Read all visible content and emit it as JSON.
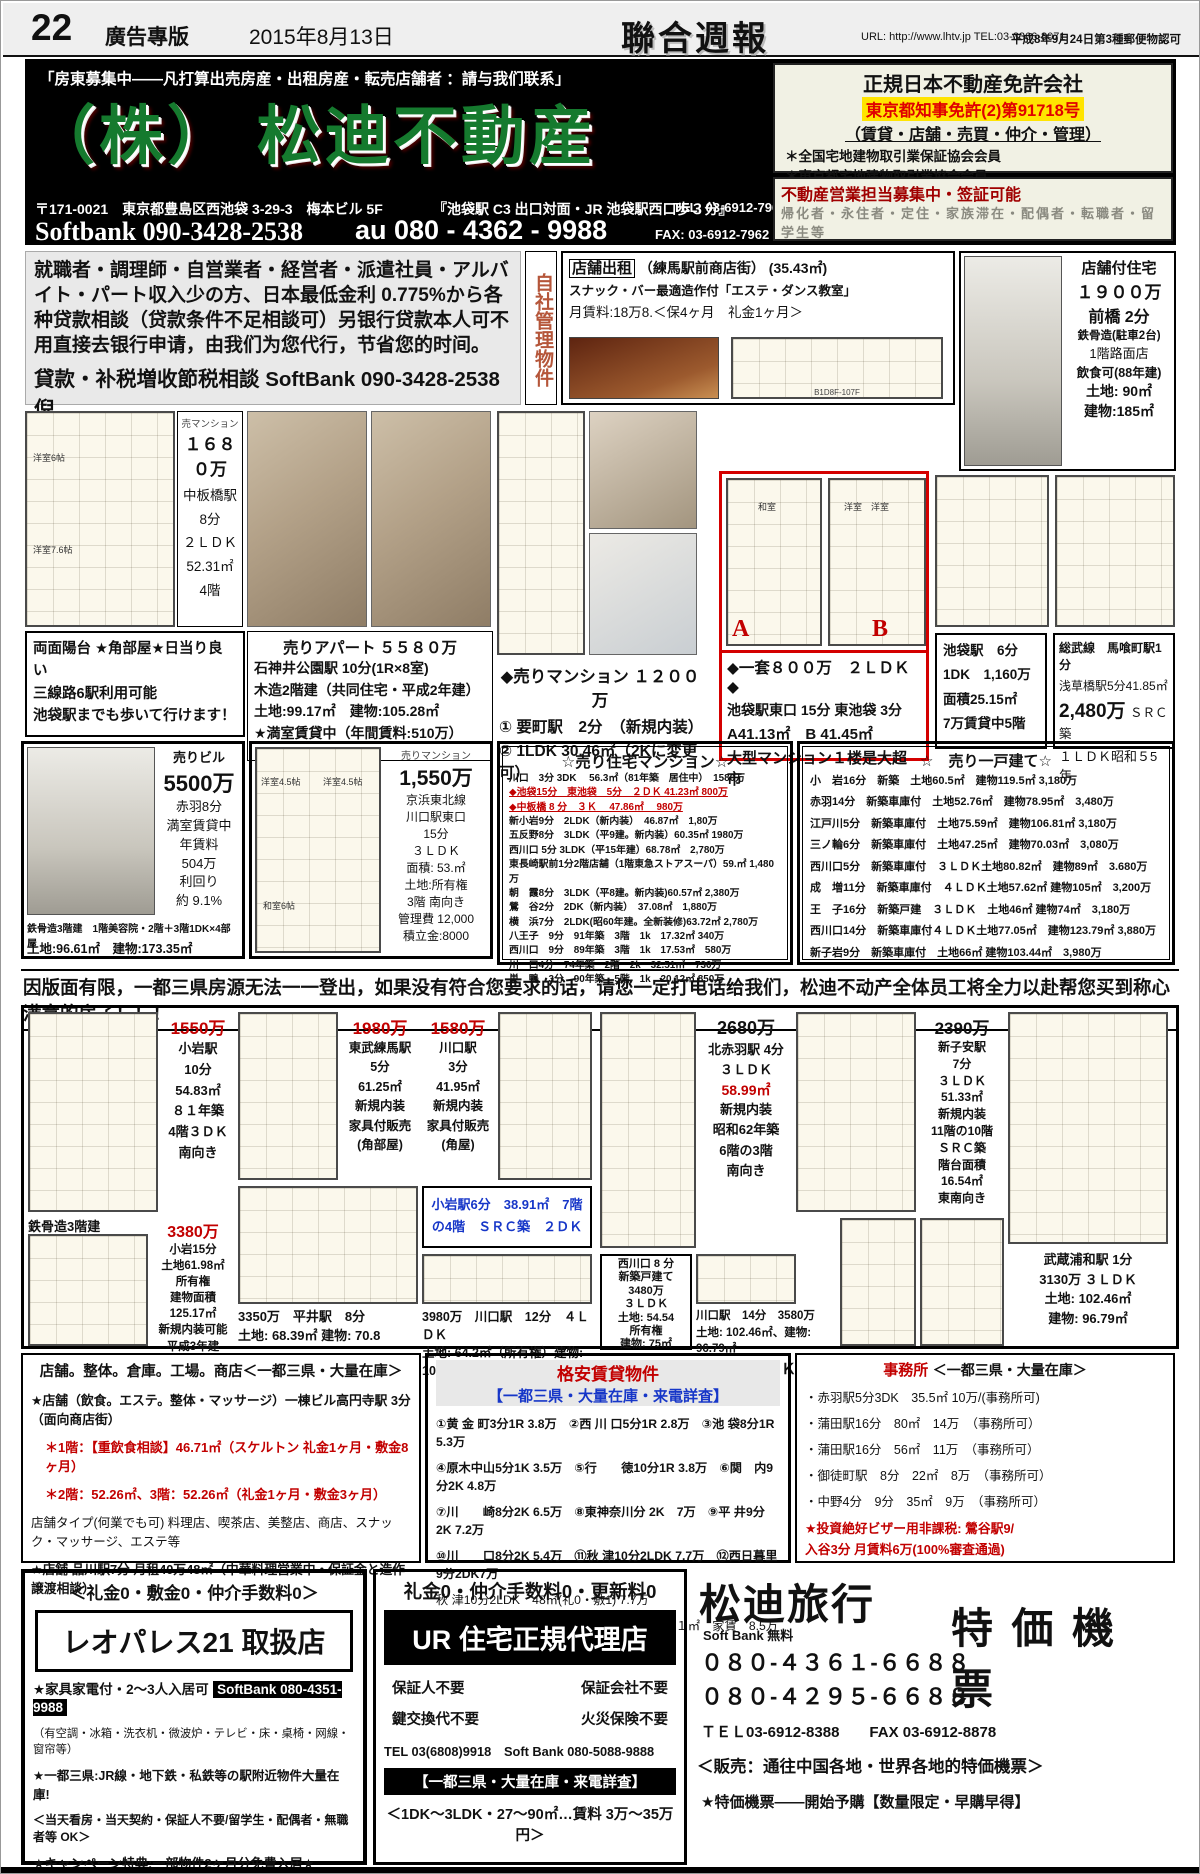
{
  "header": {
    "page_number": "22",
    "section": "廣告專版",
    "date": "2015年8月13日",
    "logo": "聯合週報",
    "contact": "URL: http://www.lhtv.jp  TEL:03-3366-8071",
    "approval": "平成8年9月24日第3種郵便物認可"
  },
  "main_ad": {
    "slogan": "「房東募集中——凡打算出売房産・出租房産・転売店舗者 ：請与我们联系」",
    "company": "（株） 松迪不動産",
    "address": "〒171-0021　東京都豊島区西池袋 3-29-3　梅本ビル 5F",
    "access": "『池袋駅 C3 出口対面・JR 池袋駅西口歩３分』",
    "tel": "TEL:  03-6912-7961",
    "softbank": "Softbank 090-3428-2538",
    "au": "au 080 - 4362 - 9988",
    "fax": "FAX:  03-6912-7962"
  },
  "license_box": {
    "title": "正規日本不動産免許会社",
    "license": "東京都知事免許(2)第91718号",
    "services": "（賃貸・店舗・売買・仲介・管理）",
    "member1": "＊全国宅地建物取引業保証協会会員",
    "member2": "＊東京都宅地建物取引業協会会員"
  },
  "recruit_box": {
    "title": "不動産営業担当募集中・签証可能",
    "body": "帰化者・永住者・定住・家族滞在・配偶者・転職者・留学生等"
  },
  "loan_ad": {
    "body": "就職者・調理師・自営業者・経営者・派遣社員・アルバイト・パート収入少の方、日本最低金利 0.775%から各种贷款相談（贷款条件不足相談可）另银行贷款本人可不用直接去银行申请，由我们为您代行，节省您的时间。",
    "contact": "貸款・补税増收節税相談 SoftBank 090-3428-2538 倪"
  },
  "self_managed": "自社管理物件",
  "shop_rent": {
    "tag": "店舗出租",
    "location": "（練馬駅前商店街）  (35.43㎡)",
    "desc": "スナック・バー最適造作付「エステ・ダンス教室」",
    "rent": "月賃料:18万8.＜保4ヶ月　礼金1ヶ月＞",
    "plan_caption": "B1D8F-107F"
  },
  "shop_house": {
    "title": "店舗付住宅",
    "price": "１９００万",
    "station": "前橋  2分",
    "structure": "鉄骨造(駐車2台)",
    "floor": "1階路面店",
    "note": "飲食可(88年建)",
    "land": "土地:  90㎡",
    "building": "建物:185㎡"
  },
  "listing_1680": {
    "tag": "売マンション",
    "price": "１６８０万",
    "details": "中板橋駅\n8分\n２ＬＤＫ\n52.31㎡\n4階",
    "rooms": [
      "洋室6帖",
      "洋室7.6帖"
    ],
    "notes": "両面陽台 ★角部屋★日当り良い\n三線路6駅利用可能\n池袋駅までも歩いて行けます！"
  },
  "listing_5580": {
    "title": "売りアパート ５５８０万",
    "details": "石神井公園駅 10分(1R×8室)\n木造2階建（共同住宅・平成2年建）\n土地:99.17㎡　建物:105.28㎡\n★満室賃貸中（年間賃料:510万）"
  },
  "listing_1200": {
    "title": "◆売りマンション １２００万",
    "line1": "① 要町駅　2分　（新規内装）",
    "line2": "② 1LDK  30.46㎡（2Kに変更可）"
  },
  "listing_800": {
    "label_a": "A",
    "label_b": "B",
    "rooms_a": "和室",
    "rooms_b": "洋室　洋室",
    "title": "◆一套８００万　２ＬＤＫ　◆",
    "line1": "池袋駅東口 15分 東池袋 3分",
    "line2": "A41.13㎡　B 41.45㎡",
    "line3": "大型マンション１楼是大超市"
  },
  "listing_ikebukuro": {
    "details": "池袋駅　6分\n1DK　1,160万\n面積25.15㎡\n7万賃貸中5階"
  },
  "listing_sobu": {
    "l1": "総武線　馬喰町駅1分",
    "l2": "浅草橋駅5分41.85㎡",
    "price": "2,480万",
    "src": "ＳＲＣ築",
    "l4": "１ＬＤＫ昭和５5年"
  },
  "listing_5500": {
    "tag": "売りビル",
    "price": "5500万",
    "details": "赤羽8分\n満室賃貸中\n年賃料\n504万\n利回り\n約 9.1%",
    "sub": "鉄骨造3階建　1階美容院・2階＋3階1DK×4部屋",
    "land": "土地:96.61㎡　建物:173.35㎡"
  },
  "listing_1550": {
    "tag": "売りマンション",
    "price": "1,550万",
    "details": "京浜東北線\n川口駅東口\n15分\n３ＬＤＫ\n面積: 53.㎡\n土地:所有権\n3階 南向き\n管理費 12,000\n積立金:8000",
    "plan_rooms": [
      "洋室4.5帖",
      "洋室4.5帖",
      "和室6帖"
    ]
  },
  "mansion_list": {
    "title": "☆売り住宅マンション☆",
    "rows": [
      "川口　3分 3DK　 56.3㎡（81年築　居住中）　1580万",
      "◆池袋15分　東池袋　5分　２ＤＫ 41.23㎡ 800万",
      "◆中板橋 8 分　３Ｋ　 47.86㎡　 980万",
      "新小岩9分　2LDK（新内装）　46.87㎡　1,80万",
      "五反野8分　3LDK（平9建。新内装）60.35㎡ 1980万",
      "西川口 5分 3LDK（平15年建）68.78㎡　2,780万",
      "東長崎駅前1分2階店舗（1階東急ストアスーパ）59.㎡ 1,480万",
      "朝　霞8分　3LDK（平8建。新内装)60.57㎡ 2,380万",
      "鶯　谷2分　2DK（新内装）　37.08㎡　1,880万",
      "横　浜7分　2LDK(昭60年建。全新装修)63.72㎡ 2,780万",
      "八王子　9分　91年築　3階　1k　17.32㎡ 340万",
      "西川口　9分　89年築　3階　1k　17.53㎡　580万",
      "川　口4分　74年築　2階　2k　32.51㎡　730万",
      "巣　鴨　3分　90年築　5階　1k　20.12㎡  850万"
    ]
  },
  "house_list": {
    "title": "☆　売り一戸建て☆",
    "rows": [
      "小　岩16分　新築　土地60.5㎡　建物119.5㎡ 3,180万",
      "赤羽14分　新築車庫付　土地52.76㎡　建物78.95㎡　3,480万",
      "江戸川5分　新築車庫付　土地75.59㎡　建物106.81㎡ 3,180万",
      "三ノ輪6分　新築車庫付　土地47.25㎡　建物70.03㎡　3,080万",
      "西川口5分　新築車庫付　３ＬＤＫ土地80.82㎡　建物89㎡　3.680万",
      "成　増11分　新築車庫付　４ＬＤＫ土地57.62㎡ 建物105㎡　3,200万",
      "王　子16分　新築戸建　３ＬＤＫ　土地46㎡ 建物74㎡　3,180万",
      "西川口14分　新築車庫付４ＬＤＫ土地77.05㎡　建物123.79㎡ 3,880万",
      "新子岩9分　新築車庫付　土地66㎡ 建物103.44㎡　3,980万"
    ]
  },
  "notice": "因版面有限，一都三県房源无法一一登出，如果没有符合您要求的话，请您一定打电话给我们，松迪不动产全体员工将全力以赴帮您买到称心满意的房子！！！",
  "mid": {
    "c1550": {
      "price": "1550万",
      "details": "小岩駅\n10分\n54.83㎡\n８１年築\n4階３ＤＫ\n南向き"
    },
    "c1980": {
      "price": "1980万",
      "details": "東武練馬駅\n5分\n61.25㎡\n新規内装\n家具付販売\n(角部屋)"
    },
    "c1580": {
      "price": "1580万",
      "details": "川口駅\n3分\n41.95㎡\n新規内装\n家具付販売\n(角屋)"
    },
    "koiwa": "小岩駅6分　38.91㎡　7階\nの4階　ＳＲＣ築　２ＤＫ",
    "c2680": {
      "price": "2680万",
      "line1": "北赤羽駅 4分\n３ＬＤＫ",
      "area": "58.99㎡",
      "line2": "新規内装\n昭和62年築\n6階の3階\n南向き"
    },
    "c2390": {
      "price": "2390万",
      "details": "新子安駅\n7分\n３ＬＤＫ\n51.33㎡\n新規内装\n11階の10階\nＳＲＣ築\n階台面積\n16.54㎡\n東南向き"
    },
    "c3380": {
      "label": "鉄骨造3階建",
      "price": "3380万",
      "details": "小岩15分\n土地61.98㎡\n所有権\n建物面積\n125.17㎡\n新規内装可能\n平成3年建"
    },
    "c3350": "3350万　平井駅　8分\n土地: 68.39㎡ 建物: 70.8",
    "c3980": "3980万　川口駅　12分　４ＬＤＫ\n土地: 64.2㎡（所有権）建物: 105.57",
    "c3480": "西川口 8 分\n新築戸建て\n3480万\n３ＬＤＫ\n土地: 54.54\n所有権\n建物: 75㎡",
    "c3580": {
      "text": "川口駅　14分　3580万\n土地: 102.46㎡、建物: 96.79㎡",
      "layout": "４ＬＤＫ"
    },
    "c3130": "武蔵浦和駅 1分\n3130万 ３ＬＤＫ\n土地: 102.46㎡\n建物: 96.79㎡"
  },
  "shop_box": {
    "header": "店舗。整体。倉庫。工場。商店＜一都三県・大量在庫＞",
    "line1": "★店舗（飲食。エステ。整体・マッサージ）一棟ビル高円寺駅 3分（面向商店街）",
    "line2": "＊1階：【重飲食相談】46.71㎡（スケルトン 礼金1ヶ月・敷金8ヶ月）",
    "line3": "＊2階：52.26㎡、3階：52.26㎡（礼金1ヶ月・敷金3ヶ月）",
    "line4": "店舗タイプ(何業でも可) 料理店、喫茶店、美整店、商店、スナック・マッサージ、エステ等",
    "line5": "★店舗 品川駅7分 月租40万48㎡（中華料理営業中・保証金と造作譲渡相談）"
  },
  "rental_box": {
    "title": "格安賃貸物件",
    "title2": "【一都三県・大量在庫・来電詳査】",
    "rows": [
      "①黄 金 町3分1R 3.8万　②西 川 口5分1R  2.8万　③池 袋8分1R 5.3万",
      "④原木中山5分1K 3.5万　⑤行　　徳10分1R 3.8万　⑥関　内9分2K 4.8万",
      "⑦川　　崎8分2K 6.5万　⑧東神奈川分 2K　7万　⑨平 井9分2K 7.2万",
      "⑩川　　口8分2K 5.4万　⑪秋 津10分2LDK 7.7万　⑫西日暮里9分2DK7万",
      "秋 津10分2LDK　48㎡(礼0・敷1) 7.7万",
      "池袋駅東口15分　東池袋駅　5分　２ＤＫ４１㎡　家賃　8.5万初期費用　34万"
    ]
  },
  "office_box": {
    "title_red": "事務所",
    "title_rest": "＜一都三県・大量在庫＞",
    "rows": [
      "・赤羽駅5分3DK　35.5㎡ 10万/(事務所可)",
      "・蒲田駅16分　80㎡　14万　（事務所可）",
      "・蒲田駅16分　56㎡　11万　（事務所可）",
      "・御徒町駅　8分　22㎡　8万　（事務所可）",
      "・中野4分　9分　35㎡　9万　（事務所可）"
    ],
    "invest1": "★投資絶好ビザー用非課税: 鶯谷駅9/",
    "invest2": "入谷3分 月賃料6万(100%審査通過)"
  },
  "leopalace": {
    "top": "＜礼金0・敷金0・仲介手数料0＞",
    "title": "レオパレス21 取扱店",
    "line1": "★家具家電付・2〜3人入居可",
    "phone": "SoftBank 080-4351-9988",
    "line2": "（有空調・冰箱・洗衣机・微波炉・テレビ・床・桌椅・网線・窗帘等）",
    "line3": "★一都三県:JR線・地下鉄・私鉄等の駅附近物件大量在庫!",
    "line4": "＜当天看房・当天契約・保証人不要/留学生・配偶者・無職者等 OK＞",
    "line5": "★キャンペーン特典:一部物件2ヶ月分免費入居★"
  },
  "ur": {
    "top": "礼金0・仲介手数料0・更新料0",
    "title": "UR 住宅正規代理店",
    "g1a": "保証人不要",
    "g1b": "保証会社不要",
    "g2a": "鍵交換代不要",
    "g2b": "火災保険不要",
    "tel": "TEL  03(6808)9918　Soft Bank  080-5088-9888",
    "band": "【一都三県・大量在庫・来電詳査】",
    "bottom": "＜1DK〜3LDK・27〜90㎡…賃料 3万〜35万円＞"
  },
  "travel": {
    "title": "松迪旅行",
    "free": "Soft Bank 無料",
    "phone1": "０８０-４３６１-６６８８",
    "phone2": "０８０-４２９５-６６８８",
    "ticket": "特 価 機 票",
    "tel": "ＴＥＬ03-6912-8388　　FAX 03-6912-8878",
    "sale": "＜販売：通往中国各地・世界各地的特価機票＞",
    "promo": "★特価機票——開始予購【数量限定・早購早得】"
  }
}
